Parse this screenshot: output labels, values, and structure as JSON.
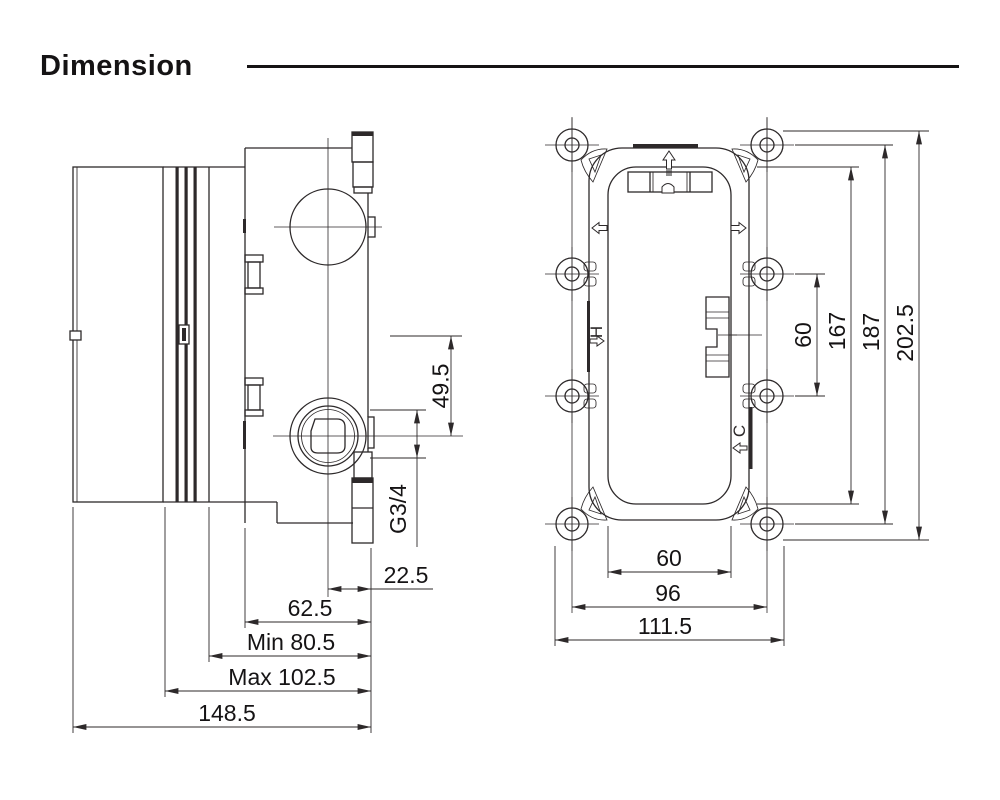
{
  "page": {
    "title": "Dimension"
  },
  "colors": {
    "line": "#2d292a",
    "text": "#151314",
    "background": "#ffffff",
    "accent_gray": "#8f8f8f"
  },
  "side_view": {
    "name": "valve body side view",
    "dimensions": {
      "outlet_drop": "49.5",
      "outlet_thread": "G3/4",
      "center_to_front": "22.5",
      "body_depth": "62.5",
      "min_depth": "Min 80.5",
      "max_depth": "Max 102.5",
      "overall_depth": "148.5"
    }
  },
  "front_view": {
    "name": "mounting bracket front view",
    "port_labels": {
      "hot": "H",
      "cold": "C"
    },
    "dimensions": {
      "port_spacing_vertical": "60",
      "inner_frame_height": "167",
      "hole_span_vertical": "187",
      "overall_height": "202.5",
      "inner_frame_width": "60",
      "hole_span_horizontal": "96",
      "overall_width": "111.5"
    }
  }
}
